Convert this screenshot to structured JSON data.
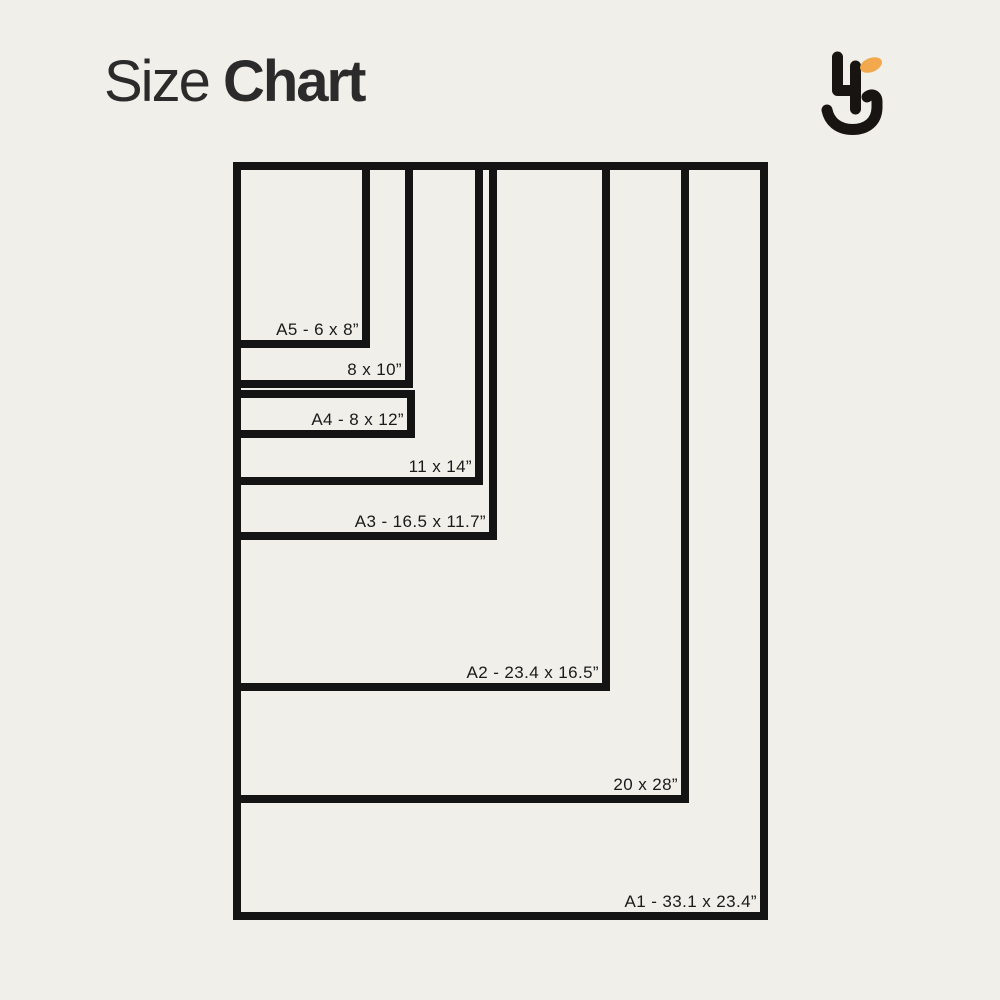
{
  "page": {
    "background": "#f1efe9",
    "width": 1000,
    "height": 1000
  },
  "header": {
    "title_regular": "Size",
    "title_bold": "Chart",
    "title_color": "#2b2b2b"
  },
  "logo": {
    "ink": "#171412",
    "accent": "#f2a94e"
  },
  "chart": {
    "line_color": "#141414",
    "label_color": "#1a1a1a",
    "unit": "inches",
    "sizes": [
      {
        "id": "a1",
        "label": "A1 - 33.1 x 23.4”",
        "width_in": 23.4,
        "height_in": 33.1,
        "box": {
          "left": 233,
          "top": 162,
          "width": 535,
          "height": 758
        }
      },
      {
        "id": "20x28",
        "label": "20 x 28”",
        "width_in": 20,
        "height_in": 28,
        "box": {
          "left": 233,
          "top": 162,
          "width": 456,
          "height": 641
        }
      },
      {
        "id": "a2",
        "label": "A2 - 23.4 x 16.5”",
        "width_in": 16.5,
        "height_in": 23.4,
        "box": {
          "left": 233,
          "top": 162,
          "width": 377,
          "height": 529
        }
      },
      {
        "id": "a3",
        "label": "A3 - 16.5 x 11.7”",
        "width_in": 11.7,
        "height_in": 16.5,
        "box": {
          "left": 233,
          "top": 162,
          "width": 264,
          "height": 378
        }
      },
      {
        "id": "11x14",
        "label": "11 x 14”",
        "width_in": 11,
        "height_in": 14,
        "box": {
          "left": 233,
          "top": 162,
          "width": 250,
          "height": 323
        }
      },
      {
        "id": "8x10",
        "label": "8 x 10”",
        "width_in": 8,
        "height_in": 10,
        "box": {
          "left": 233,
          "top": 162,
          "width": 180,
          "height": 226
        }
      },
      {
        "id": "a5",
        "label": "A5 - 6 x 8”",
        "width_in": 6,
        "height_in": 8,
        "box": {
          "left": 233,
          "top": 162,
          "width": 137,
          "height": 186
        }
      },
      {
        "id": "a4",
        "label": "A4 - 8 x 12”",
        "width_in": 8,
        "height_in": 12,
        "box": {
          "left": 233,
          "top": 390,
          "width": 182,
          "height": 48
        }
      }
    ]
  }
}
